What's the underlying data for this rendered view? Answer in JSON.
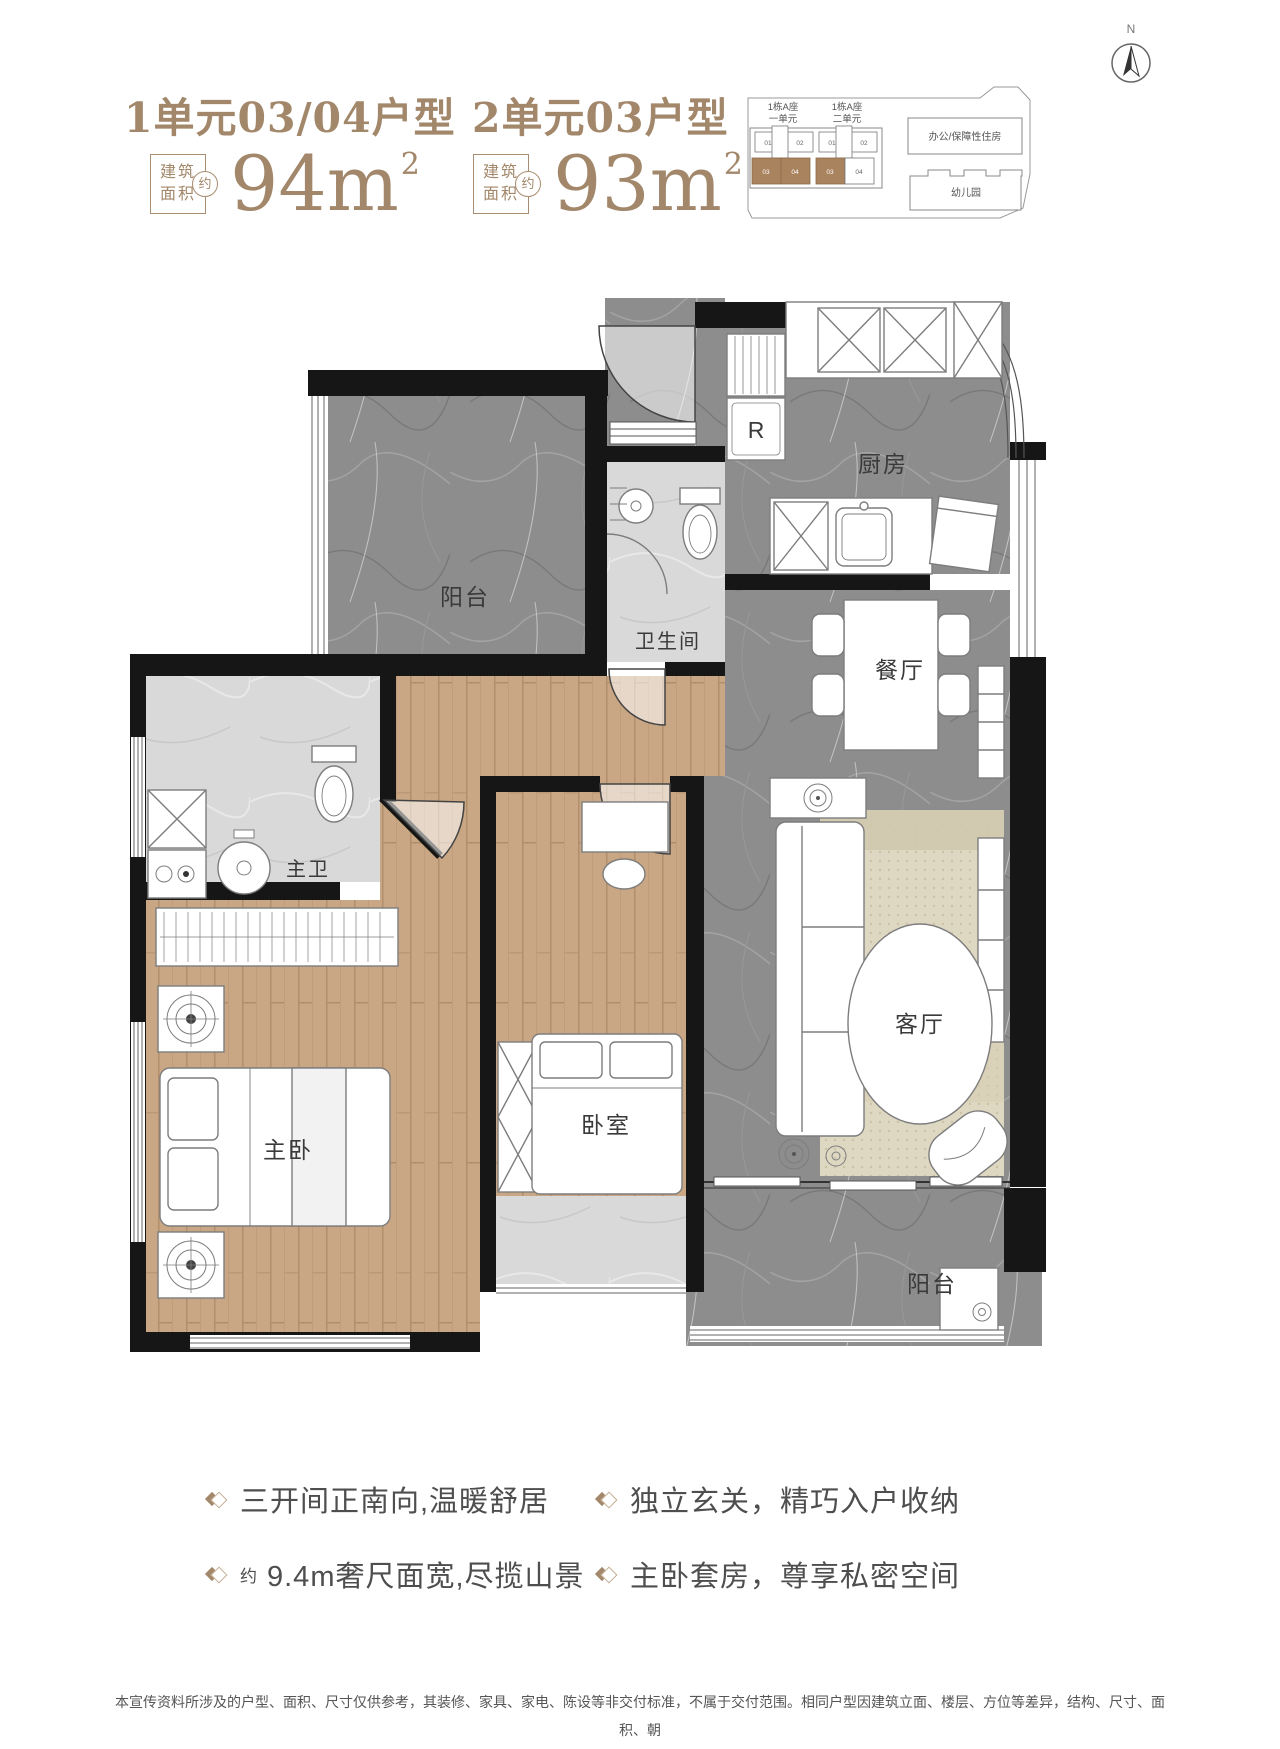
{
  "header": {
    "unit1_title": "1单元03/04户型",
    "unit2_title": "2单元03户型",
    "area_word_top": "建筑",
    "area_word_bottom": "面积",
    "approx_word": "约",
    "unit1_area": "94m",
    "unit2_area": "93m",
    "sup": "2"
  },
  "compass": {
    "north_label": "N"
  },
  "keyplan": {
    "block1_line1": "1栋A座",
    "block1_line2": "一单元",
    "block2_line1": "1栋A座",
    "block2_line2": "二单元",
    "u1c1": "01",
    "u1c2": "02",
    "u1c3": "03",
    "u1c4": "04",
    "u2c1": "01",
    "u2c2": "02",
    "u2c3": "03",
    "u2c4": "04",
    "office": "办公/保障性住房",
    "kindergarten": "幼儿园"
  },
  "plan": {
    "balcony_top": "阳台",
    "bath": "卫生间",
    "kitchen": "厨房",
    "fridge": "R",
    "dining": "餐厅",
    "master_bath": "主卫",
    "master_bed": "主卧",
    "bedroom": "卧室",
    "living": "客厅",
    "balcony_bottom": "阳台"
  },
  "features": {
    "f1": "三开间正南向,温暖舒居",
    "f2": "独立玄关，精巧入户收纳",
    "f3_prefix": "约",
    "f3": "9.4m奢尺面宽,尽揽山景",
    "f4": "主卧套房，尊享私密空间"
  },
  "disclaimer": {
    "line1": "本宣传资料所涉及的户型、面积、尺寸仅供参考，其装修、家具、家电、陈设等非交付标准，不属于交付范围。相同户型因建筑立面、楼层、方位等差异，结构、尺寸、面积、朝",
    "line2": "向及室内布局可能存在不同，最终以政府审批文件及双方签订的买卖合同及附件为准。本公司保留对宣传资料修改的权利，敬请留意最新资料。"
  },
  "colors": {
    "brand_brown": "#a2876a",
    "keyplan_highlight": "#a9835e",
    "wall_black": "#161616",
    "marble_dark": "#8d8d8d",
    "tile_light": "#d9d9d9",
    "wood": "#c9a785",
    "rug": "#ded7c1",
    "feature_text": "#4e4e4e",
    "disclaimer_text": "#555555"
  }
}
